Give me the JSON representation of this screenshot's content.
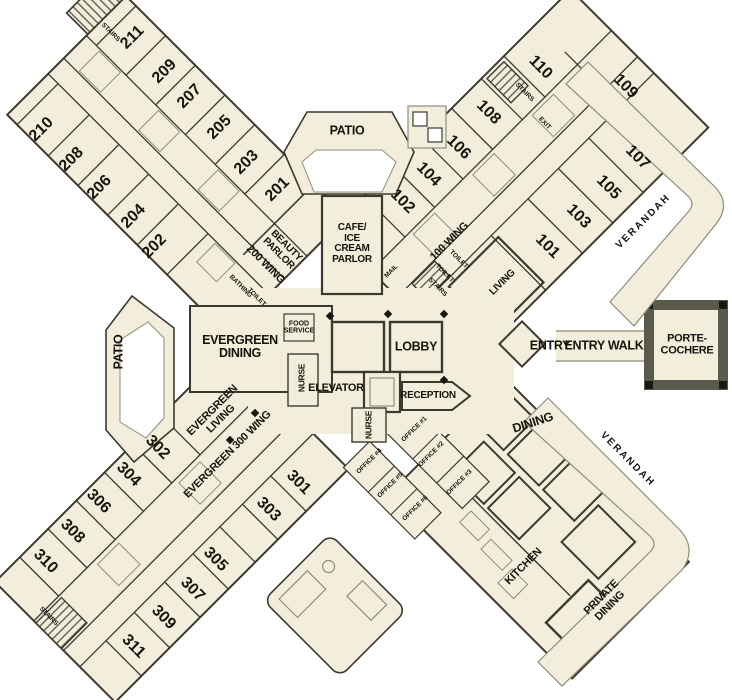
{
  "colors": {
    "floor": "#F2EEDB",
    "wall": "#3B3A2F",
    "thin_line": "#8F8D7C",
    "text": "#15150D",
    "frame_dark": "#5A594E"
  },
  "labels": {
    "patio": "PATIO",
    "cafe": "CAFE/\nICE\nCREAM\nPARLOR",
    "beauty_parlor": "BEAUTY\nPARLOR",
    "wing_200": "200 WING",
    "wing_100": "100 WING",
    "wing_300": "EVERGREEN 300 WING",
    "evergreen_dining": "EVERGREEN\nDINING",
    "evergreen_living": "EVERGREEN\nLIVING",
    "food_service": "FOOD\nSERVICE",
    "nurse": "NURSE",
    "lobby": "LOBBY",
    "elevator": "ELEVATOR",
    "reception": "RECEPTION",
    "entry": "ENTRY",
    "entry_walk": "ENTRY WALK",
    "porte_cochere": "PORTE-\nCOCHERE",
    "verandah": "VERANDAH",
    "living": "LIVING",
    "dining": "DINING",
    "private_dining": "PRIVATE\nDINING",
    "kitchen": "KITCHEN",
    "mail": "MAIL",
    "bathing": "BATHING",
    "toilet": "TOILET",
    "stairs": "STAIRS",
    "exit": "EXIT"
  },
  "offices": [
    "OFFICE #1",
    "OFFICE #2",
    "OFFICE #3",
    "OFFICE #4",
    "OFFICE #5",
    "OFFICE #6"
  ],
  "rooms": {
    "wing200_ne": [
      "211",
      "209",
      "207",
      "205",
      "203",
      "201"
    ],
    "wing200_sw": [
      "210",
      "208",
      "206",
      "204",
      "202"
    ],
    "wing100_nw": [
      "102",
      "104",
      "106",
      "108",
      "110"
    ],
    "wing100_se": [
      "101",
      "103",
      "105",
      "107",
      "109"
    ],
    "wing300_nw": [
      "310",
      "308",
      "306",
      "304",
      "302"
    ],
    "wing300_se": [
      "311",
      "309",
      "307",
      "305",
      "303",
      "301"
    ]
  }
}
